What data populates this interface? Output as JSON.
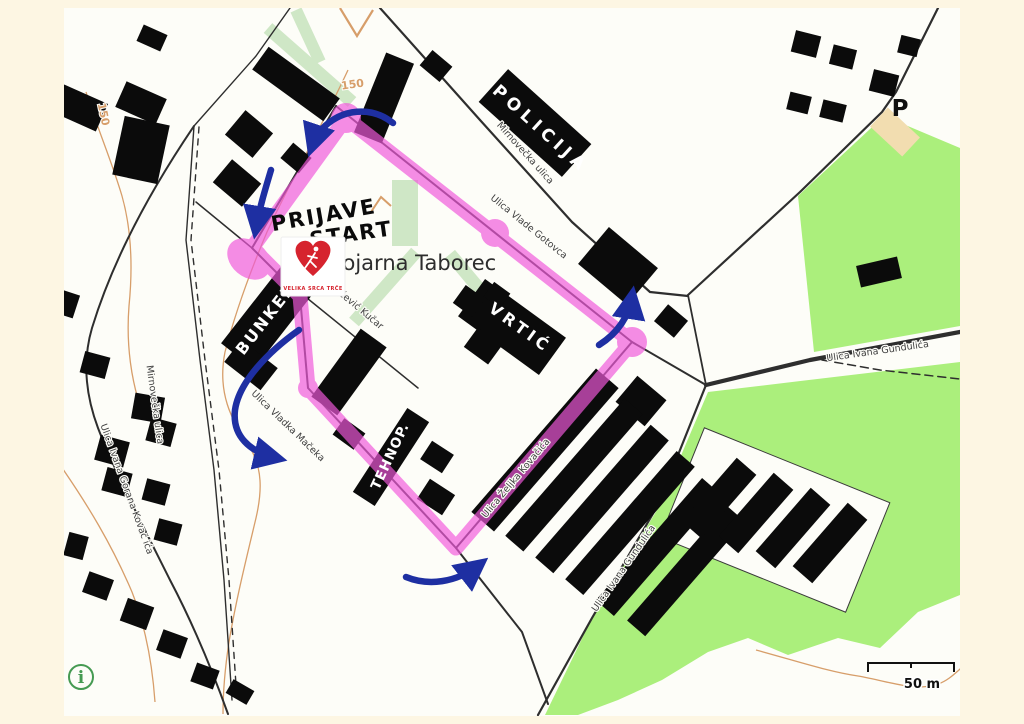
{
  "map": {
    "place": "Vojarna Taborec",
    "streets": {
      "mirnovecka_top": "Mirnovečka ulica",
      "mirnovecka_left": "Mirnovečka ulica",
      "vlade_gotovca": "Ulica Vlade Gotovca",
      "dabcevic_kucar": "Dabčević Kučar",
      "vladka_maceka": "Ulica Vladka Mačeka",
      "zeljka_kovacica": "Ulica Željka Kovačića",
      "ivana_gundulica_upper": "Ulica Ivana Gundulića",
      "ivana_gundulica_lower": "Ulica Ivana Gundulića",
      "ivana_gorana_kovacica": "Ulica Ivana Gorana Kovač ića"
    },
    "contours": {
      "top": "150",
      "left": "150"
    },
    "parking": "P",
    "scale": "50 m",
    "info": "i"
  },
  "annotations": {
    "policija": "POLICIJA",
    "prijave": "PRIJAVE",
    "start": "START",
    "bunker": "BUNKER",
    "vrtic": "VRTIĆ",
    "tehnop": "TEHNOP."
  },
  "logo": {
    "text": "VELIKA SRCA TRČE"
  },
  "colors": {
    "frame": "#fdf6e3",
    "canvas": "#fdfdf8",
    "route": "#f158db",
    "arrow": "#1e2fa2",
    "green": "#abef7c",
    "walkway": "#cfe7c6",
    "building": "#0b0b0b",
    "contour": "#d79e6a",
    "parking_area": "#f2ddb0",
    "logo_red": "#d6232e",
    "info_green": "#459a52"
  }
}
